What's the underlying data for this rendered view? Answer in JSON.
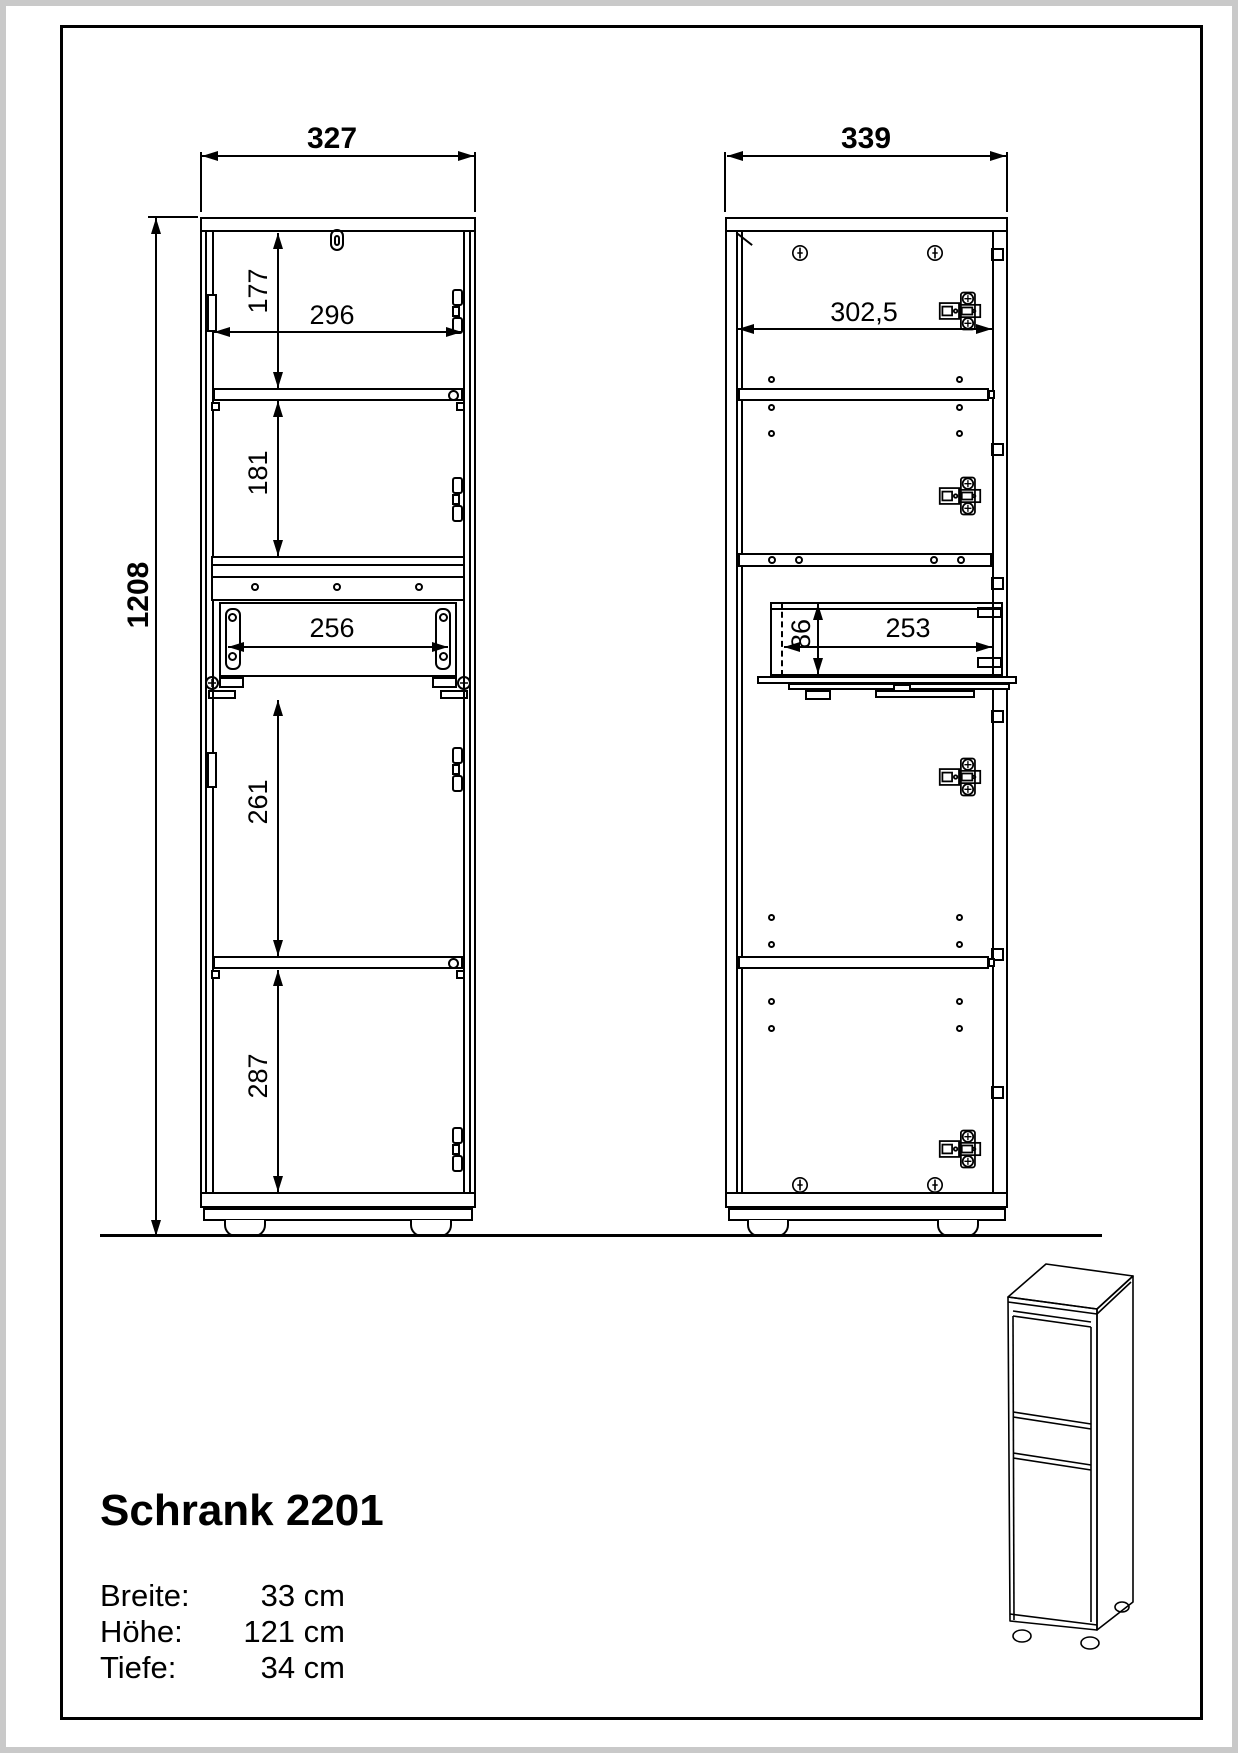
{
  "product": {
    "name": "Schrank 2201",
    "specs": [
      {
        "label": "Breite:",
        "value": "33 cm"
      },
      {
        "label": "Höhe:",
        "value": "121 cm"
      },
      {
        "label": "Tiefe:",
        "value": "34 cm"
      }
    ]
  },
  "front_view": {
    "dims": {
      "overall_width": "327",
      "overall_height": "1208",
      "inner_width": "296",
      "top_section": "177",
      "second_section": "181",
      "drawer_opening": "256",
      "third_section": "261",
      "bottom_section": "287"
    }
  },
  "side_view": {
    "dims": {
      "overall_width": "339",
      "inner_width": "302,5",
      "drawer_height": "86",
      "drawer_depth": "253"
    }
  },
  "colors": {
    "line": "#000000",
    "background": "#ffffff",
    "frame": "#000000",
    "page_edge": "#c9c9c9"
  }
}
